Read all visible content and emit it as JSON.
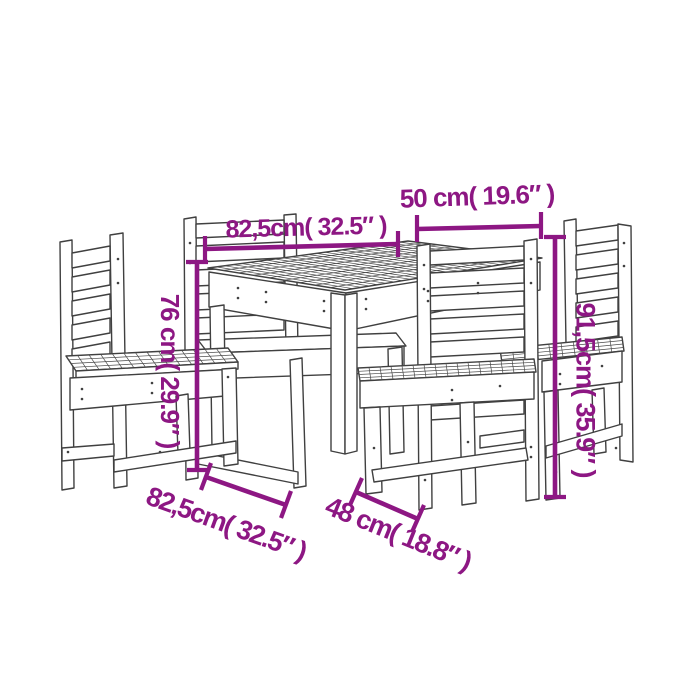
{
  "page": {
    "background": "#ffffff",
    "kind": "product dimension diagram",
    "subject": "5-piece wooden dining set line drawing: square slatted-top table with four slat-back chairs"
  },
  "colors": {
    "dimension_accent": "#8D1783",
    "line_art": "#404040"
  },
  "dimensions": {
    "table_width_label": "82,5cm( 32.5″ )",
    "chair_width_label": "50 cm( 19.6″ )",
    "table_height_label": "76 cm( 29.9″ )",
    "chair_height_label": "91,5cm( 35.9″ )",
    "table_depth_label": "82,5cm( 32.5″ )",
    "chair_depth_label": "48 cm( 18.8″ )"
  }
}
